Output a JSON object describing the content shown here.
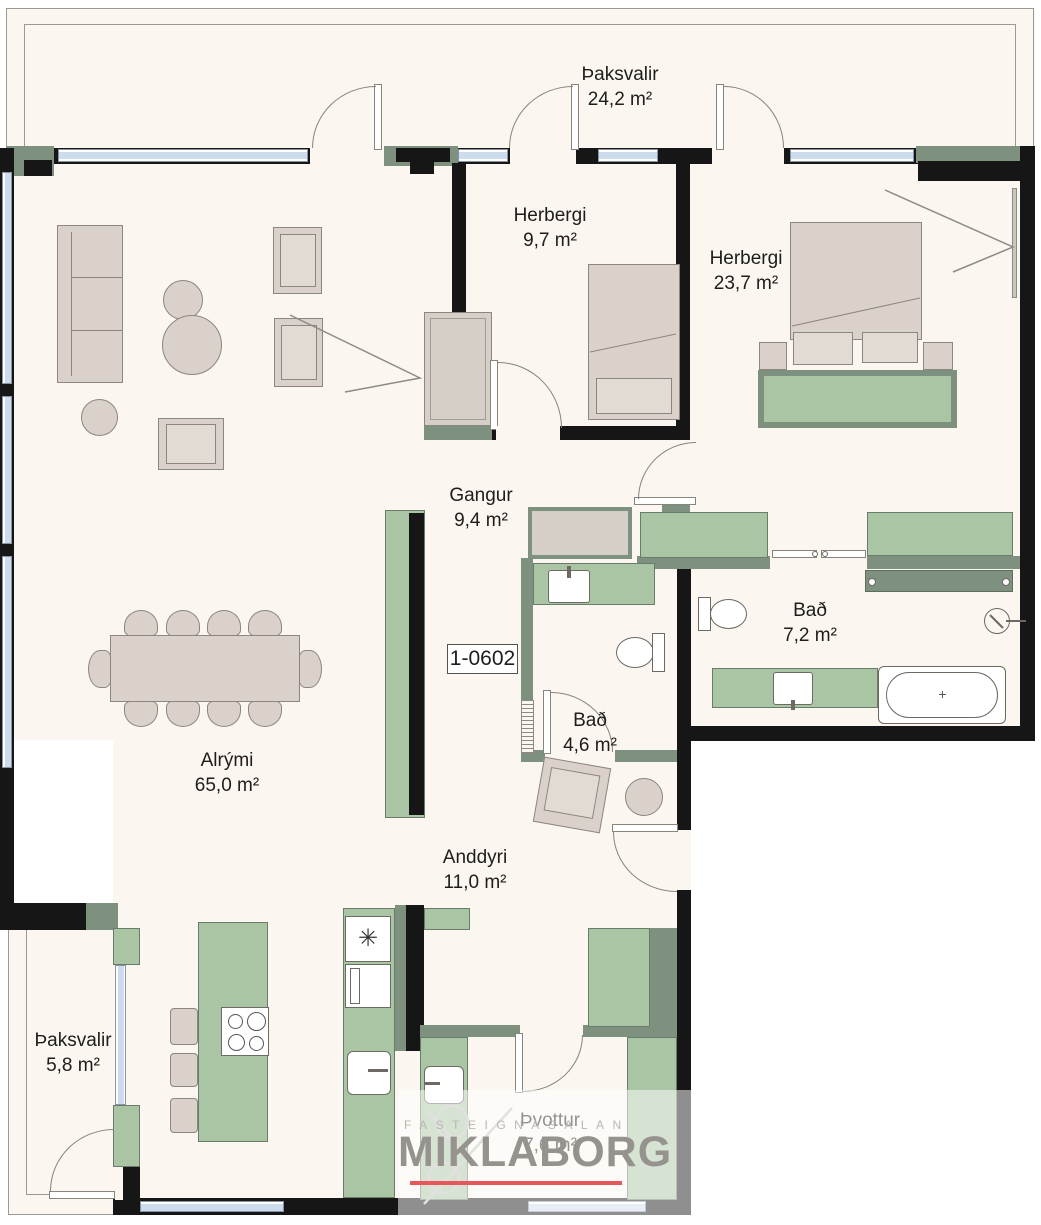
{
  "unit_id": "1-0602",
  "rooms": [
    {
      "name": "Þaksvalir",
      "area": "24,2 m²"
    },
    {
      "name": "Herbergi",
      "area": "9,7 m²"
    },
    {
      "name": "Herbergi",
      "area": "23,7 m²"
    },
    {
      "name": "Gangur",
      "area": "9,4 m²"
    },
    {
      "name": "Bað",
      "area": "7,2 m²"
    },
    {
      "name": "Bað",
      "area": "4,6 m²"
    },
    {
      "name": "Alrými",
      "area": "65,0 m²"
    },
    {
      "name": "Anddyri",
      "area": "11,0 m²"
    },
    {
      "name": "Þaksvalir",
      "area": "5,8 m²"
    },
    {
      "name": "Þvottur",
      "area": "7,6 m²"
    }
  ],
  "logo": {
    "tagline": "FASTEIGNASALAN",
    "brand": "MIKLABORG"
  },
  "colors": {
    "wall": "#161616",
    "cabinet_green": "#a9c5a3",
    "wall_green": "#7d917e",
    "furniture": "#d9d1ca",
    "window": "#ccdcec",
    "floor": "#fbf6f0",
    "logo_red": "#e8555a"
  }
}
